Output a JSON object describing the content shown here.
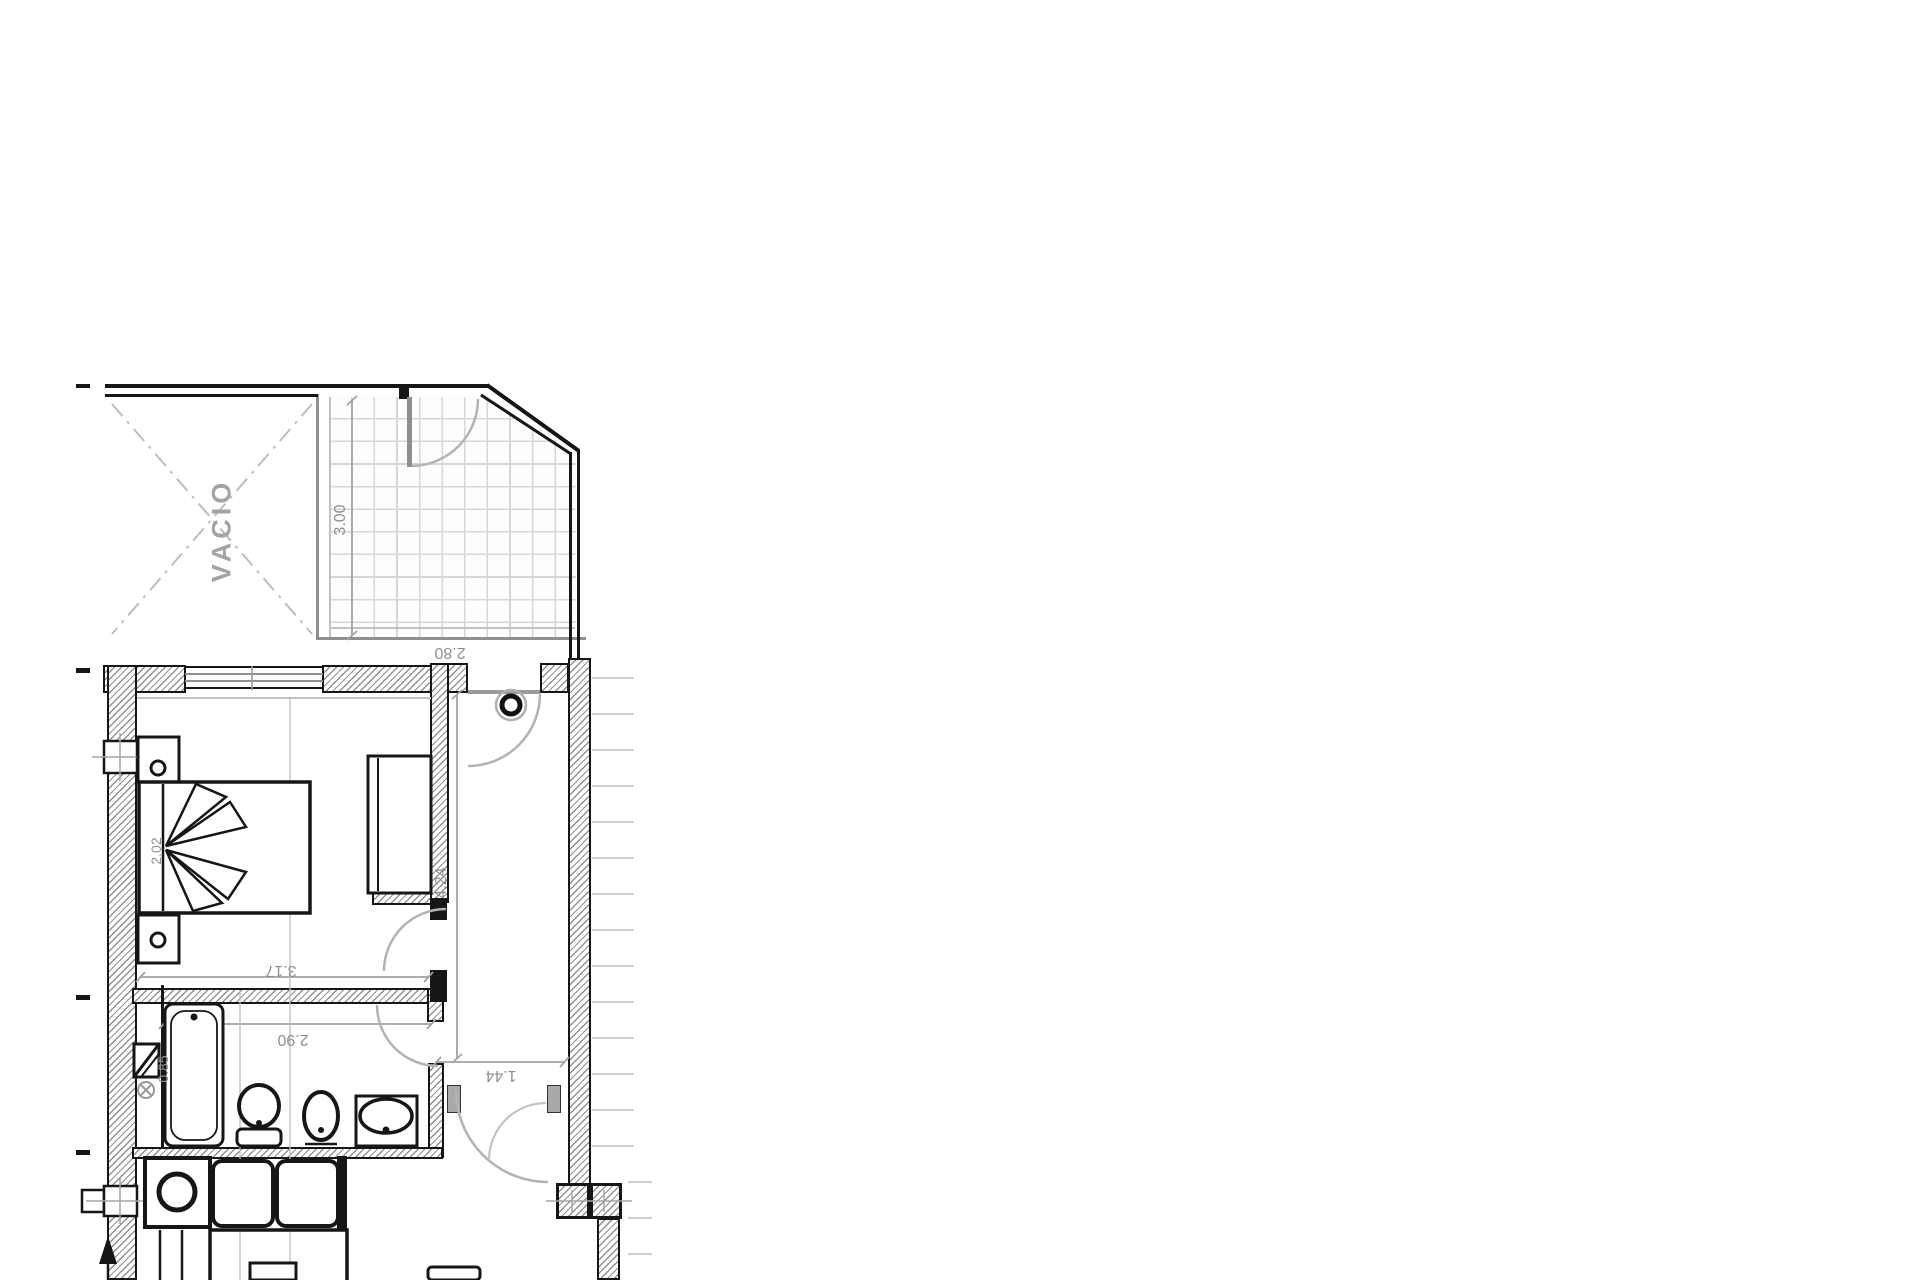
{
  "plan": {
    "labels": {
      "void_area": "VACIO"
    },
    "dimensions": {
      "terrace_depth": "3.00",
      "terrace_width": "2.80",
      "bedroom_width": "3.17",
      "bed_length": "2.02",
      "hall_length": "4.24",
      "bathroom_width": "2.90",
      "corridor_width": "1.44",
      "bath_fixture": "0.85"
    },
    "colors": {
      "ink": "#161616",
      "dim_text": "#8f8f8f",
      "dim_line": "#a2a2a2",
      "tile_line": "#d6d6d6",
      "door_arc": "#b3b3b3",
      "hatch_line": "#929292"
    }
  }
}
